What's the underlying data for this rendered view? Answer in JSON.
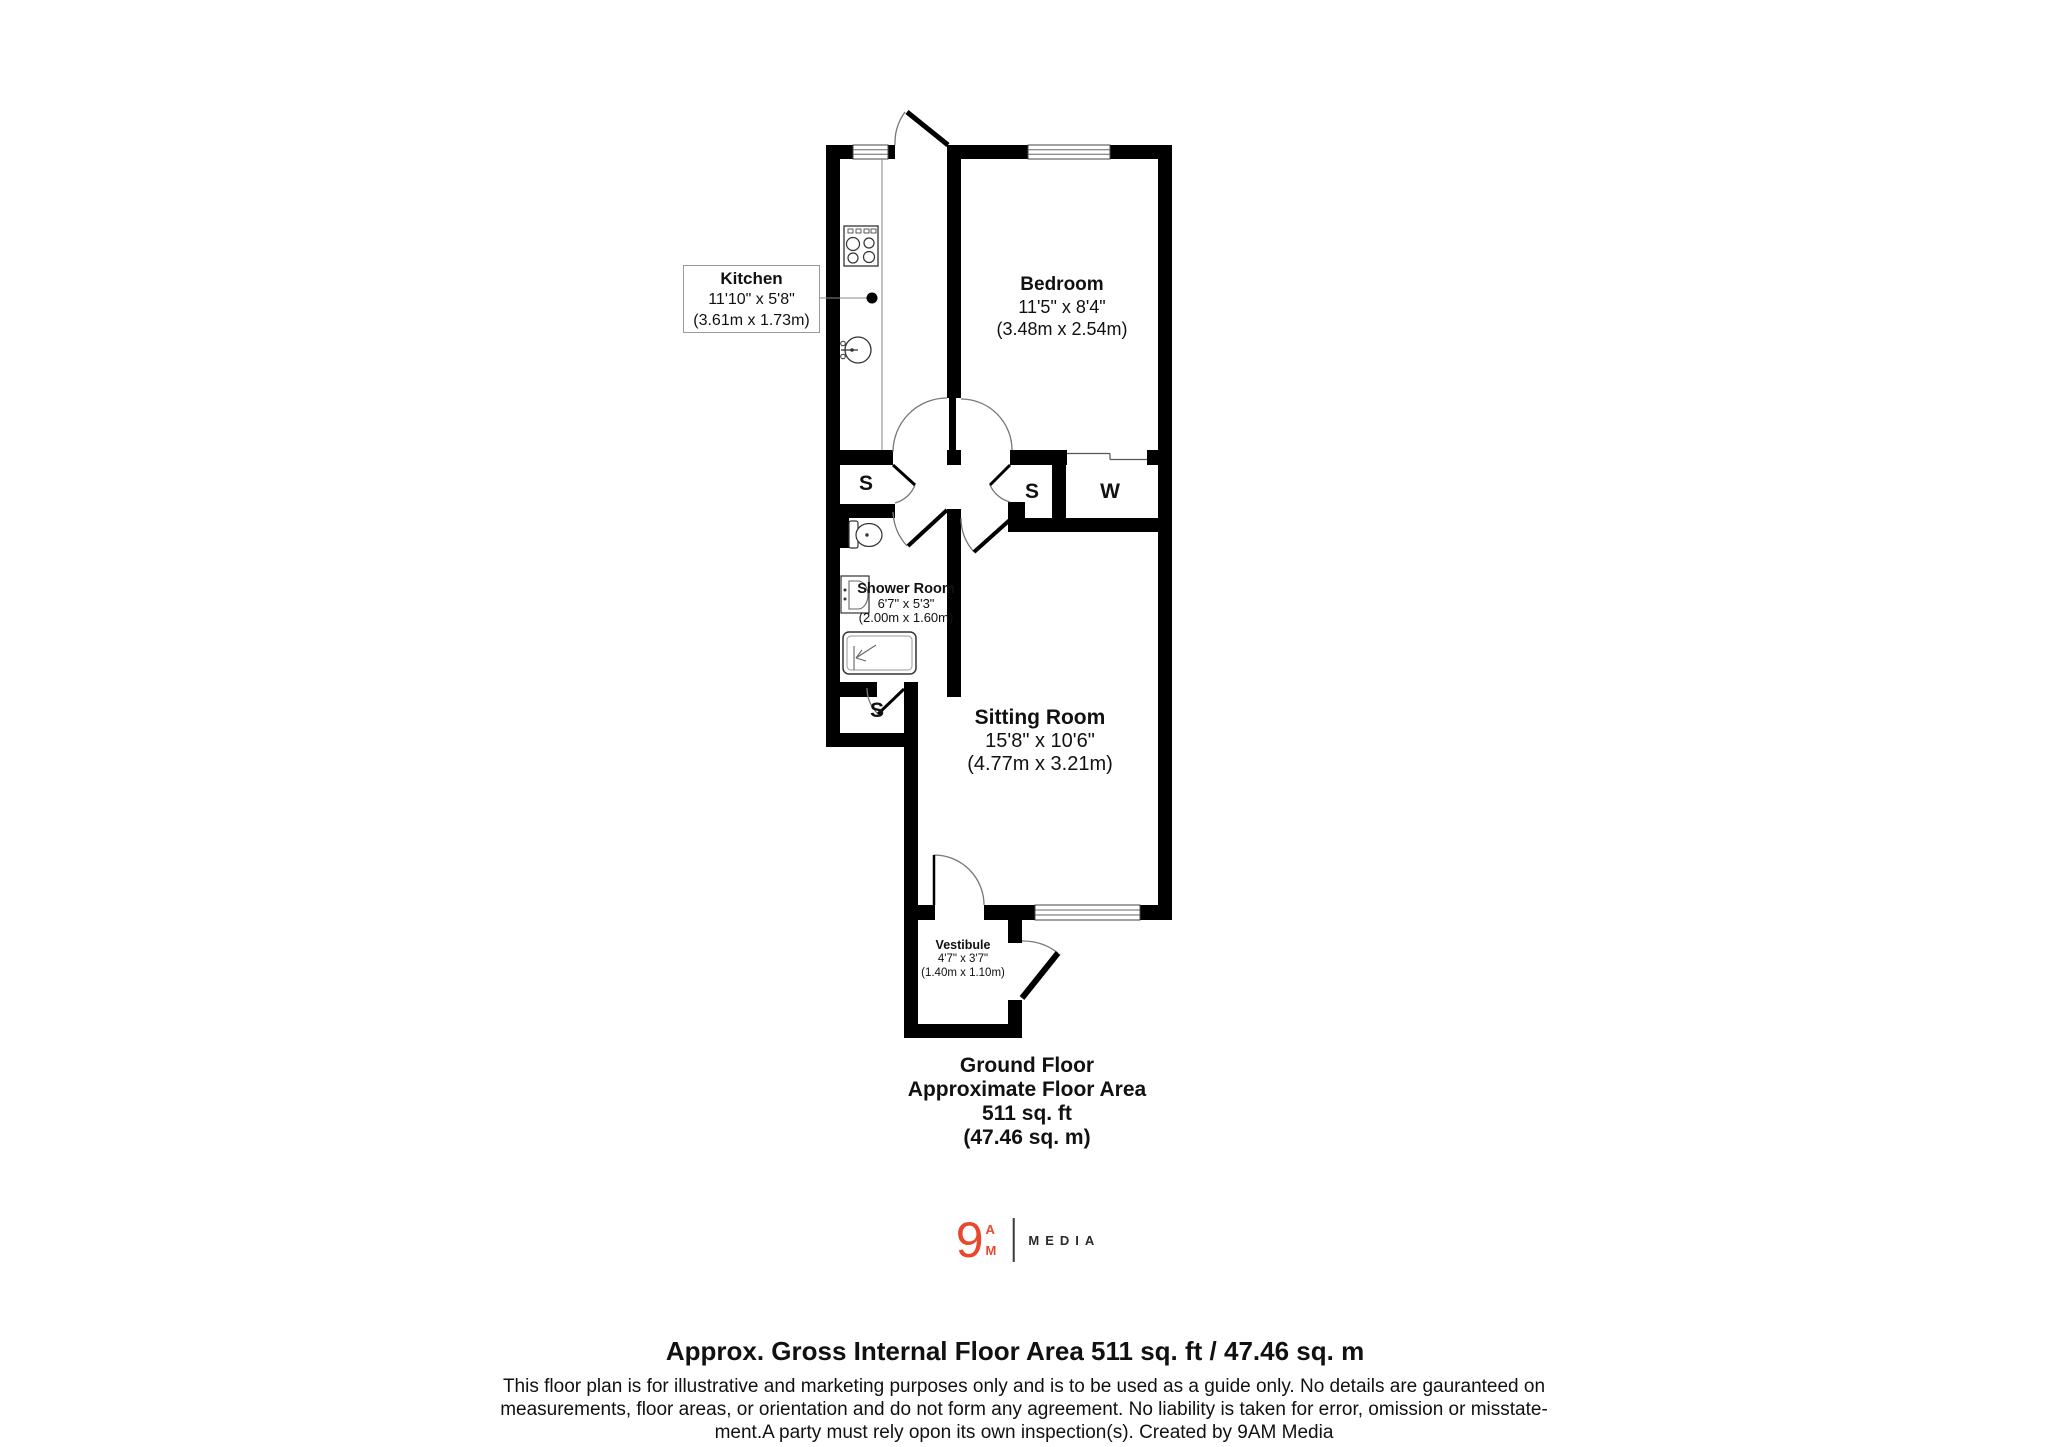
{
  "plan": {
    "rooms": [
      {
        "id": "kitchen",
        "name": "Kitchen",
        "dims_imperial": "11'10\" x 5'8\"",
        "dims_metric": "(3.61m x 1.73m)"
      },
      {
        "id": "bedroom",
        "name": "Bedroom",
        "dims_imperial": "11'5\" x 8'4\"",
        "dims_metric": "(3.48m x 2.54m)"
      },
      {
        "id": "shower_room",
        "name": "Shower Room",
        "dims_imperial": "6'7\" x 5'3\"",
        "dims_metric": "(2.00m x 1.60m)"
      },
      {
        "id": "sitting_room",
        "name": "Sitting Room",
        "dims_imperial": "15'8\" x 10'6\"",
        "dims_metric": "(4.77m x 3.21m)"
      },
      {
        "id": "vestibule",
        "name": "Vestibule",
        "dims_imperial": "4'7\" x 3'7\"",
        "dims_metric": "(1.40m x 1.10m)"
      }
    ],
    "storage_label": "S",
    "wardrobe_label": "W",
    "wall_color": "#000000",
    "door_arc_color": "#777777"
  },
  "floor_summary": {
    "line1": "Ground Floor",
    "line2": "Approximate Floor Area",
    "line3": "511 sq. ft",
    "line4": "(47.46 sq. m)"
  },
  "logo": {
    "numeral": "9",
    "letter_top": "A",
    "letter_bottom": "M",
    "brand": "MEDIA",
    "accent_color": "#e8492e"
  },
  "footer": {
    "title": "Approx. Gross Internal Floor Area 511 sq. ft / 47.46 sq. m",
    "disclaimer_lines": [
      "This floor plan is for illustrative and marketing purposes only and is to be used as a guide only. No details are gauranteed on",
      "measurements, floor areas, or orientation and do not form any agreement. No liability is taken for error, omission or misstate-",
      "ment.A party must rely opon its own inspection(s). Created by 9AM Media"
    ]
  }
}
